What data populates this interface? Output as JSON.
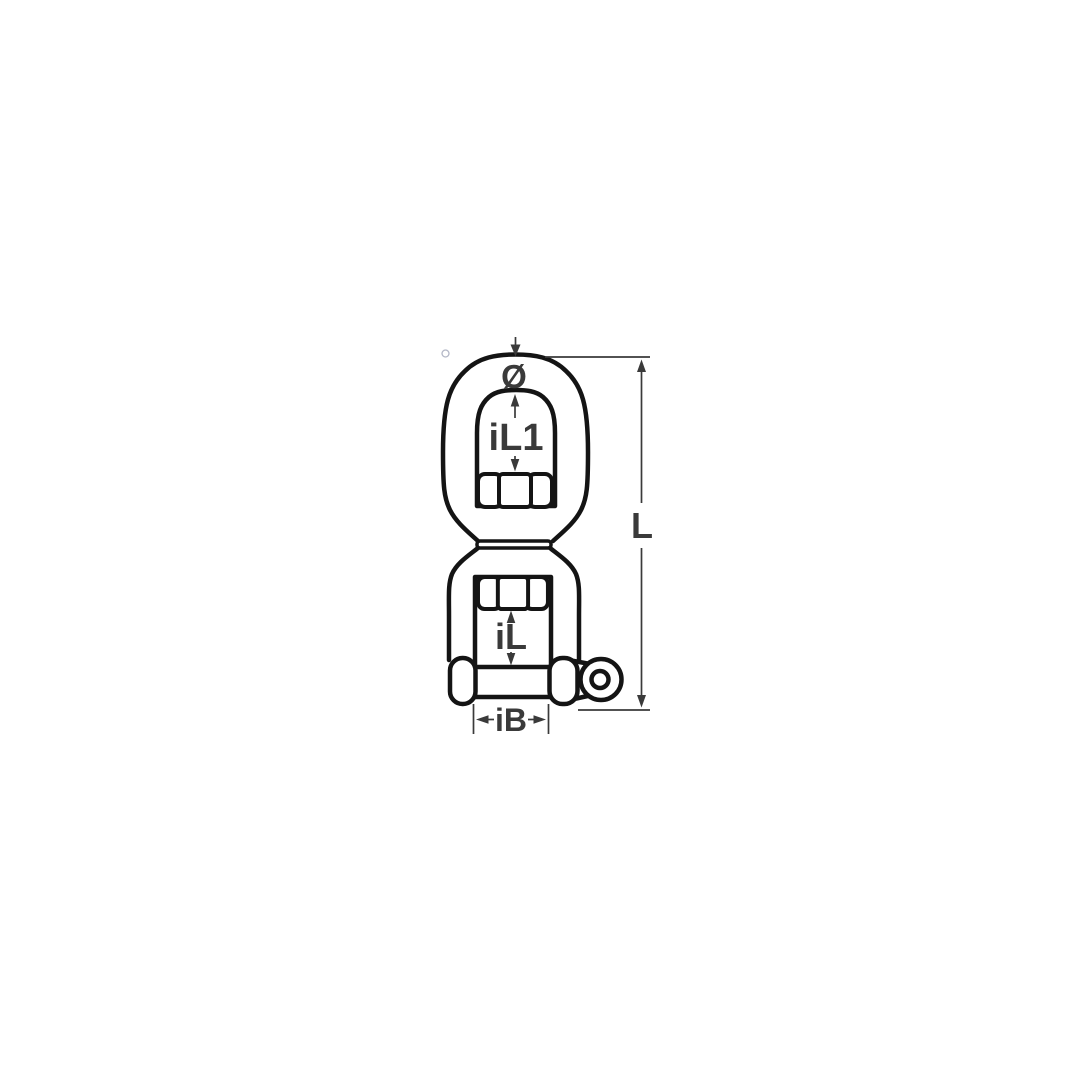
{
  "figure": {
    "kind": "technical-line-drawing",
    "subject": "Eye and fork swivel shackle with hex nuts and eyed bolt",
    "background_color": "#ffffff",
    "outline_color": "#141414",
    "dimension_color": "#3a3a3a",
    "stray_dot_color": "#b3b7c6",
    "labels": {
      "pin_diameter": "Ø",
      "eye_inner_length": "iL1",
      "overall_length": "L",
      "fork_inner_length": "iL",
      "fork_inner_width": "iB"
    }
  }
}
